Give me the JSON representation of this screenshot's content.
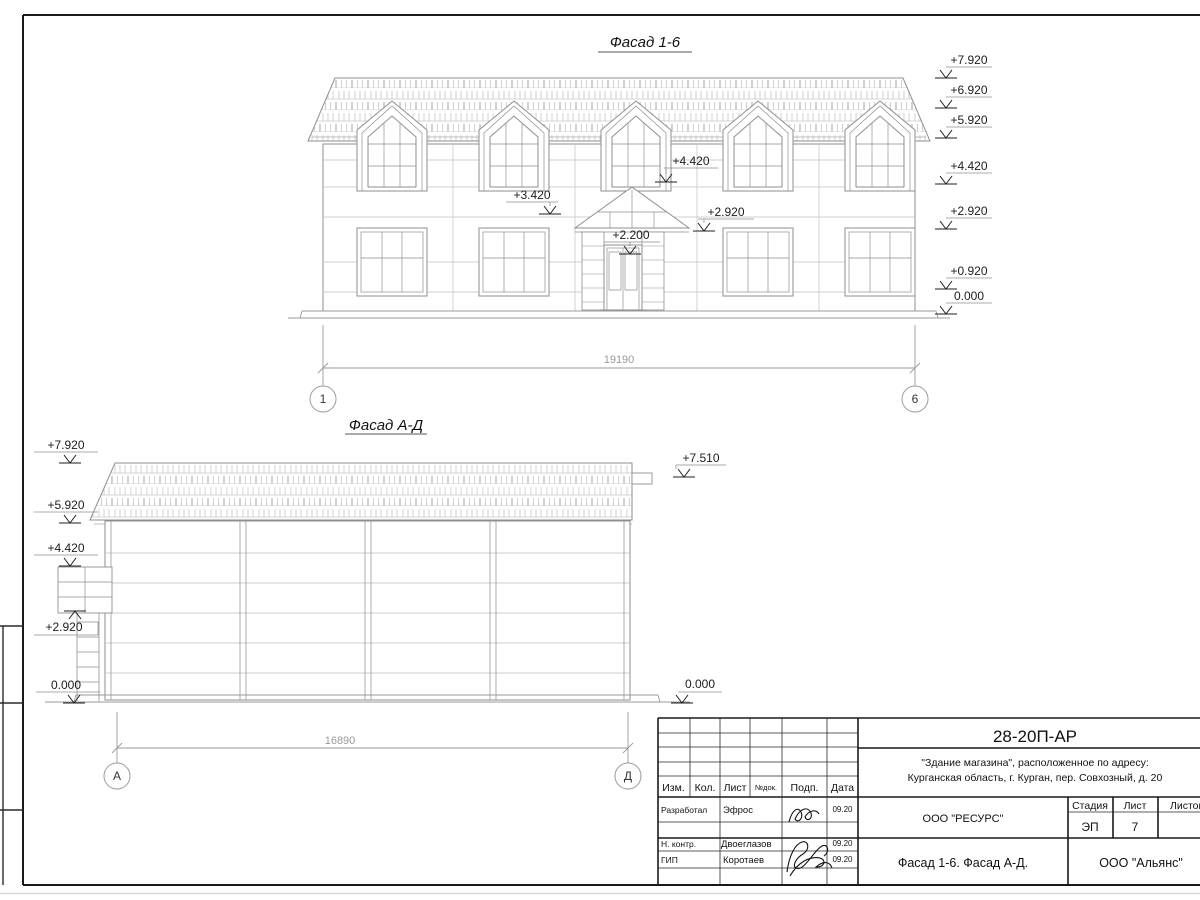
{
  "sheet": {
    "facade16": {
      "title": "Фасад 1-6",
      "dim_label": "19190",
      "axis_left": "1",
      "axis_right": "6",
      "marks_right": [
        "+7.920",
        "+6.920",
        "+5.920",
        "+4.420",
        "+2.920",
        "+0.920",
        "0.000"
      ],
      "mark_4420": "+4.420",
      "mark_3420": "+3.420",
      "mark_2920": "+2.920",
      "mark_2200": "+2.200"
    },
    "facadeAD": {
      "title": "Фасад А-Д",
      "dim_label": "16890",
      "axis_left": "А",
      "axis_right": "Д",
      "marks_left": [
        "+7.920",
        "+5.920",
        "+4.420",
        "+2.920",
        "0.000"
      ],
      "mark_7510": "+7.510",
      "mark_0000_right": "0.000"
    },
    "titleblock": {
      "doc_number": "28-20П-АР",
      "project_line1": "\"Здание магазина\", расположенное по адресу:",
      "project_line2": "Курганская область, г. Курган, пер. Совхозный, д. 20",
      "col_izm": "Изм.",
      "col_kol": "Кол.",
      "col_list": "Лист",
      "col_ndok": "№док.",
      "col_podp": "Подп.",
      "col_data": "Дата",
      "row1_role": "Разработал",
      "row1_name": "Эфрос",
      "row1_date": "09.20",
      "row2_role": "Н. контр.",
      "row2_name": "Двоеглазов",
      "row2_date": "09.20",
      "row3_role": "ГИП",
      "row3_name": "Коротаев",
      "row3_date": "09.20",
      "org_designer": "ООО \"РЕСУРС\"",
      "stage_label": "Стадия",
      "sheet_label": "Лист",
      "sheets_label": "Листов",
      "stage_value": "ЭП",
      "sheet_value": "7",
      "drawing_title": "Фасад 1-6. Фасад А-Д.",
      "org_customer": "ООО \"Альянс\""
    }
  }
}
